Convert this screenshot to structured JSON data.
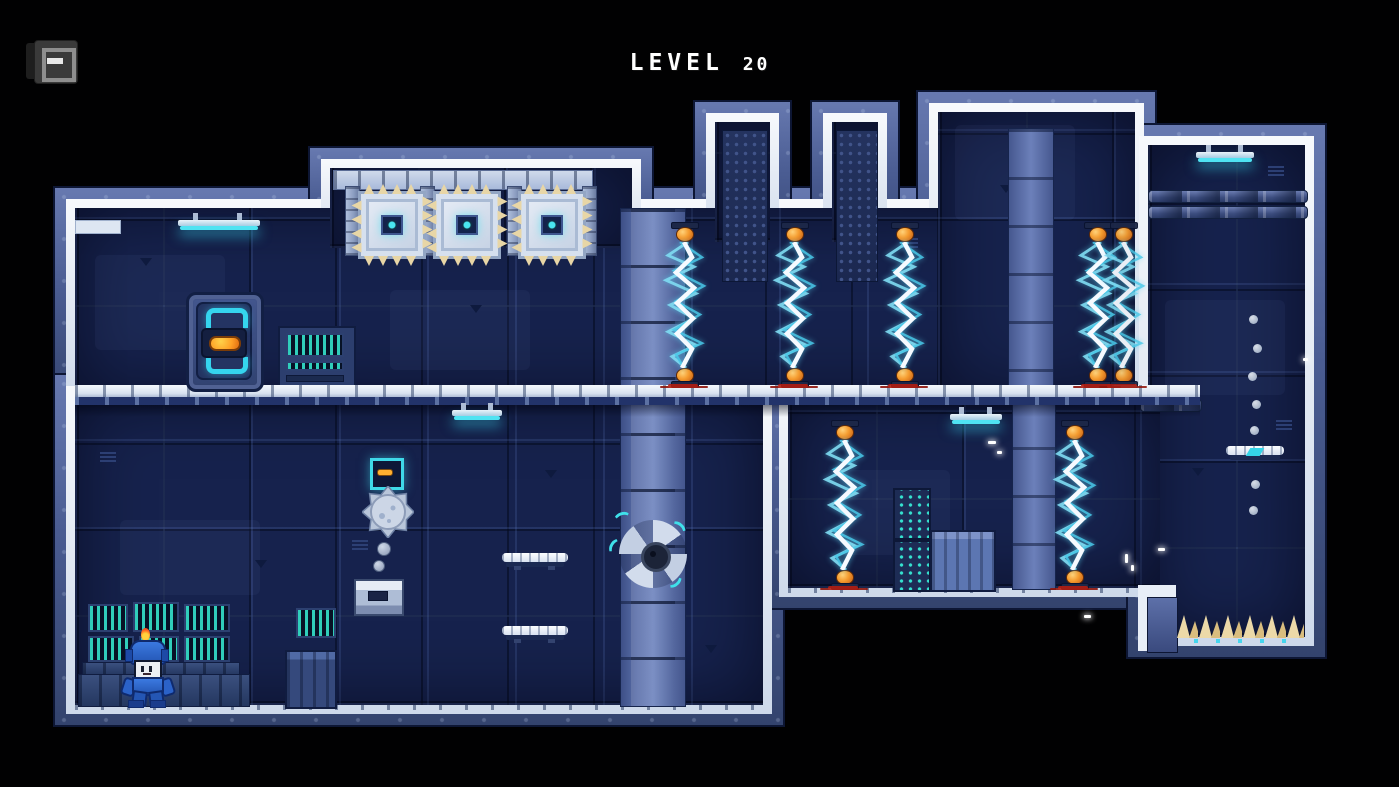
{
  "hud": {
    "menu_icon": "journal-icon",
    "title_level": "LEVEL",
    "title_number": "20"
  },
  "level": {
    "number": 20,
    "theme": "dark sci-fi facility platformer",
    "hazard_counts": {
      "electric_beams": 7,
      "spike_blocks": 3,
      "saw_fan": 1,
      "spiked_ball": 1,
      "floor_spike_rows": 1
    },
    "entities": [
      {
        "name": "exit-door",
        "x": 186,
        "y": 292
      },
      {
        "name": "door-console",
        "x": 278,
        "y": 326
      },
      {
        "name": "player",
        "x": 124,
        "y": 628
      },
      {
        "name": "console-wall",
        "x": 85,
        "y": 600
      },
      {
        "name": "crate",
        "x": 285,
        "y": 650
      },
      {
        "name": "crate-light",
        "x": 930,
        "y": 530
      },
      {
        "name": "mini-console-stack",
        "x": 893,
        "y": 488
      },
      {
        "name": "ceiling-lamp",
        "x": 178,
        "y": 216
      },
      {
        "name": "ceiling-lamp",
        "x": 452,
        "y": 406
      },
      {
        "name": "ceiling-lamp",
        "x": 950,
        "y": 410
      },
      {
        "name": "ceiling-lamp",
        "x": 1196,
        "y": 148
      },
      {
        "name": "spike-block",
        "x": 358,
        "y": 191
      },
      {
        "name": "spike-block",
        "x": 433,
        "y": 191
      },
      {
        "name": "spike-block",
        "x": 518,
        "y": 191
      },
      {
        "name": "electric-beam",
        "x": 685,
        "y": 222
      },
      {
        "name": "electric-beam",
        "x": 795,
        "y": 222
      },
      {
        "name": "electric-beam",
        "x": 905,
        "y": 222
      },
      {
        "name": "electric-beam",
        "x": 1063,
        "y": 222
      },
      {
        "name": "electric-beam",
        "x": 1089,
        "y": 222
      },
      {
        "name": "electric-beam",
        "x": 845,
        "y": 420
      },
      {
        "name": "electric-beam",
        "x": 1075,
        "y": 420
      },
      {
        "name": "saw-fan",
        "x": 619,
        "y": 520
      },
      {
        "name": "switch-box",
        "x": 370,
        "y": 458
      },
      {
        "name": "spiked-ball",
        "x": 362,
        "y": 486
      },
      {
        "name": "ball-dispenser",
        "x": 354,
        "y": 579
      },
      {
        "name": "hover-platform",
        "x": 502,
        "y": 553
      },
      {
        "name": "hover-platform",
        "x": 502,
        "y": 626
      },
      {
        "name": "hover-platform",
        "x": 1226,
        "y": 446
      },
      {
        "name": "floor-spikes",
        "x": 1176,
        "y": 611
      },
      {
        "name": "pipes",
        "x": 1148,
        "y": 190
      },
      {
        "name": "long-walkway",
        "x": 75,
        "y": 385
      }
    ],
    "palette": {
      "background_black": "#010102",
      "wall_navy": "#16224d",
      "frame_blue": "#4a5c92",
      "border_white": "#e8eef7",
      "bolt_white": "#f6faff",
      "bolt_cyan": "#49c8e8",
      "electrode_orange": "#f59b2e",
      "spike_beige": "#ecd9a8",
      "screen_teal": "#34e2cb",
      "accent_cyan": "#3fd9e8",
      "handle_orange": "#ffa126",
      "player_blue": "#2a60c4",
      "flame_orange": "#ff5a28",
      "splatter_red": "#b21d10"
    }
  }
}
